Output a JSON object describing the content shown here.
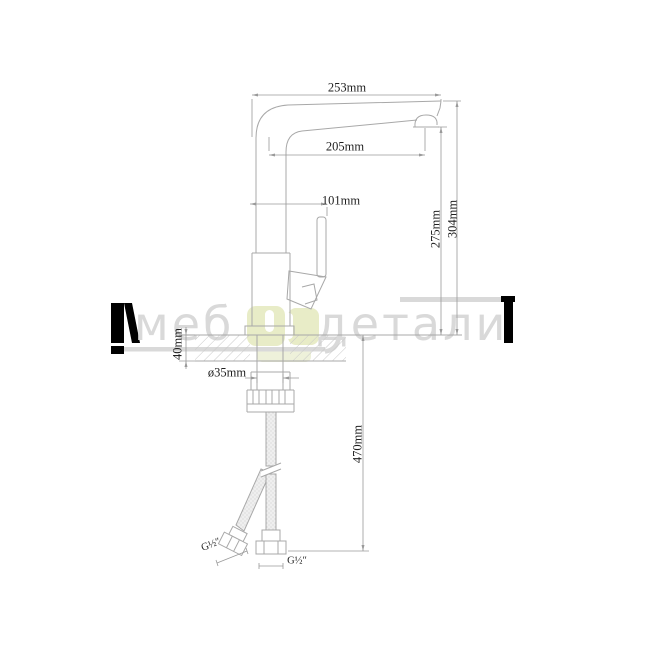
{
  "watermark": {
    "left": "меб",
    "right": "детали"
  },
  "dimensions": {
    "d253": "253mm",
    "d205": "205mm",
    "d101": "101mm",
    "d275": "275mm",
    "d304": "304mm",
    "d40": "40mm",
    "d35": "ø35mm",
    "d470": "470mm",
    "g_left": "G½″",
    "g_right": "G½″"
  },
  "colors": {
    "object_line": "#a8a8a8",
    "dimension_line": "#9a9a9a",
    "label_text": "#1f1f1f",
    "watermark_gray": "#d9d9d9",
    "watermark_green": "#e8ecc7",
    "watermark_black": "#000000"
  }
}
